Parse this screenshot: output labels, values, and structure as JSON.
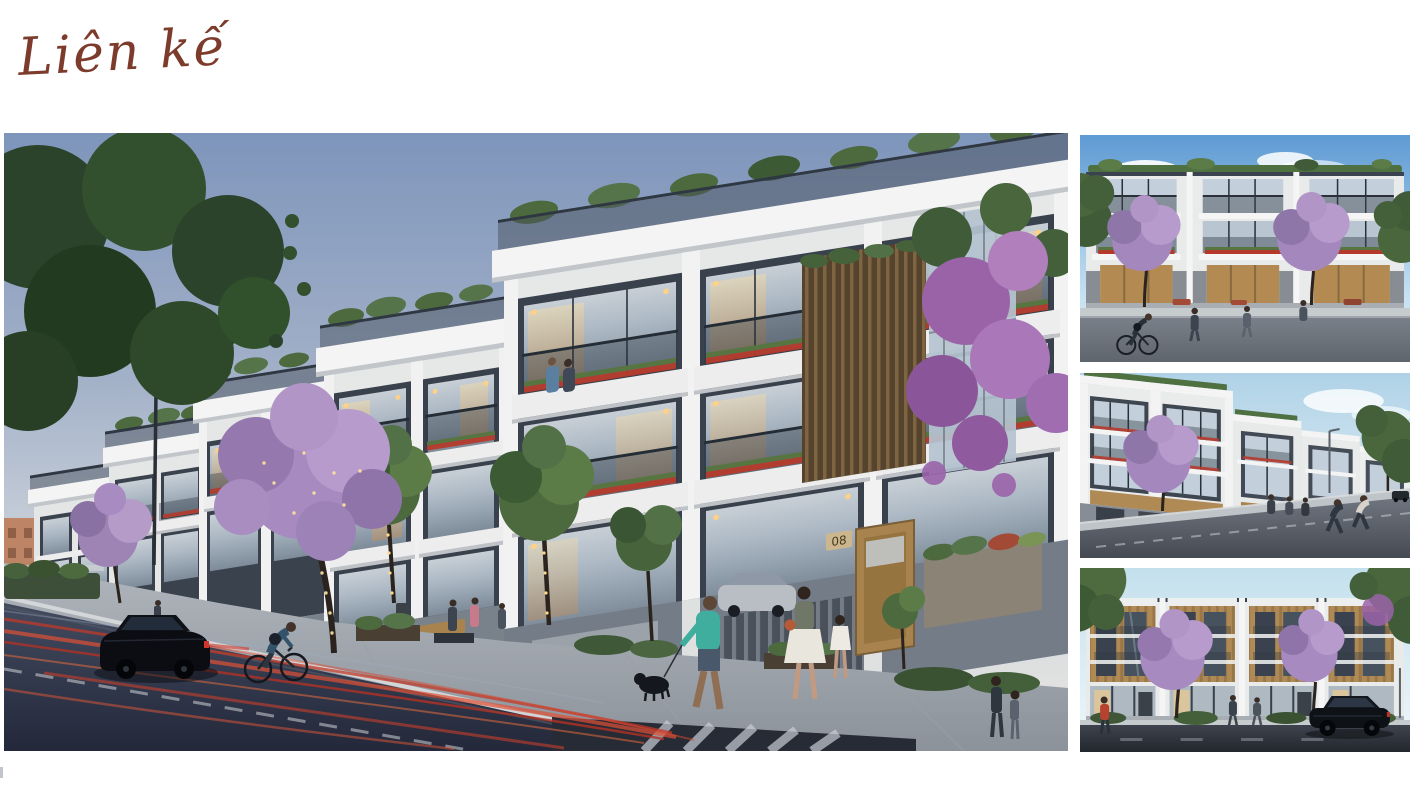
{
  "header": {
    "title": "Liên kế",
    "title_color": "#7D3B2B"
  },
  "gallery": {
    "main_image": {
      "house_number": "08",
      "alt": "Dusk street-level perspective of a row of modern four-storey Lien ke townhouses with glass balconies, flowering trees with string lights, pedestrians, a cyclist, a black sedan and red light trails on the road"
    },
    "thumbnails": [
      {
        "alt": "Daytime front elevation of white townhouses with rooftop greenery, purple flowering trees and a passing cyclist"
      },
      {
        "alt": "Daytime angled street view of the townhouse row receding to the right with joggers on the road"
      },
      {
        "alt": "Front elevation of townhouses with bronze louvre facades, purple flowering trees and a black sedan parked on the street"
      }
    ]
  },
  "colors": {
    "accent_title": "#7D3B2B",
    "dusk_sky": "#7E95BB",
    "day_sky": "#5E9AD3",
    "facade_white": "#E8E9E9",
    "facade_dark": "#39414D",
    "wood_tan": "#B08A55",
    "foliage_green": "#3A5A33",
    "blossom_purple": "#A78ABF",
    "road_dark": "#2A3040",
    "light_trail_red": "#D03A2A"
  }
}
